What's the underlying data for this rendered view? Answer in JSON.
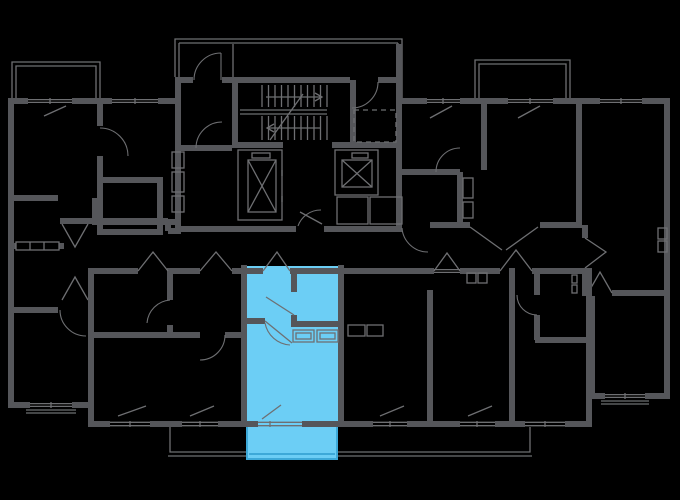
{
  "colors": {
    "background": "#000000",
    "walls": "#55565a",
    "thin_lines": "#6e6f72",
    "highlight_fill": "#6ccef5",
    "highlight_outline": "#3da9d8"
  },
  "floor_plan": {
    "type": "residential-floor-plan",
    "highlighted_unit": {
      "style": "studio",
      "rooms": [
        "entrance-hall",
        "bathroom",
        "living-room",
        "balcony"
      ],
      "fill": "#6ccef5",
      "position": "bottom-center"
    },
    "core": {
      "elements": [
        "staircase-two-flights",
        "elevator-shaft-left",
        "elevator-shaft-right",
        "vestibule",
        "service-shafts",
        "dashed-shaft-zone"
      ]
    },
    "wings": [
      "left-wing",
      "top-right-wing",
      "bottom-row",
      "far-right-apartment"
    ],
    "balconies": [
      "top-left-balcony",
      "top-right-balcony",
      "bottom-balcony-strip",
      "highlighted-unit-balcony"
    ],
    "icons": [
      {
        "name": "elevator-x-icon",
        "meaning": "elevator shaft cross"
      },
      {
        "name": "stair-treads-icon",
        "meaning": "staircase treads with direction arrows"
      },
      {
        "name": "door-arc-icon",
        "meaning": "door swing"
      },
      {
        "name": "window-glazing-icon",
        "meaning": "window double line"
      }
    ]
  }
}
